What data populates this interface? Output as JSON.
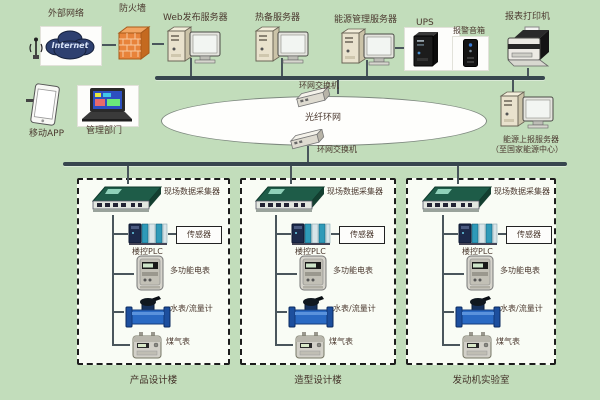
{
  "colors": {
    "background": "#c2ddbb",
    "building_box_fill": "#f9fcf5",
    "bus": "#37464e",
    "connector": "#4a565c",
    "label_text": "#4b392f",
    "firewall_orange": "#e8833a",
    "cloud_blue": "#2e4070",
    "collector_green": "#1e5c48",
    "plc_teal": "#2e9ab8",
    "water_meter_blue": "#2a6ac4",
    "ups_black": "#1c1c1c"
  },
  "top_row": {
    "external_network": {
      "label": "外部网络",
      "cloud_text": "Internet"
    },
    "firewall": {
      "label": "防火墙"
    },
    "web_server": {
      "label": "Web发布服务器"
    },
    "standby_server": {
      "label": "热备服务器"
    },
    "energy_mgmt_server": {
      "label": "能源管理服务器"
    },
    "ups": {
      "label": "UPS"
    },
    "alarm_speaker": {
      "label": "报警音箱"
    },
    "report_printer": {
      "label": "报表打印机"
    }
  },
  "left_panel": {
    "mobile_app": {
      "label": "移动APP"
    },
    "mgmt_dept": {
      "label": "管理部门"
    }
  },
  "ring_network": {
    "ellipse_label": "光纤环网",
    "top_switch_label": "环网交换机",
    "bottom_switch_label": "环网交换机"
  },
  "report_server": {
    "label_line1": "能源上报服务器",
    "label_line2": "（至国家能源中心）"
  },
  "buildings": [
    {
      "name": "产品设计楼",
      "collector": "现场数据采集器",
      "sensor": "传感器",
      "plc": "楼控PLC",
      "electric_meter": "多功能电表",
      "water_meter": "水表/流量计",
      "gas_meter": "煤气表"
    },
    {
      "name": "造型设计楼",
      "collector": "现场数据采集器",
      "sensor": "传感器",
      "plc": "楼控PLC",
      "electric_meter": "多功能电表",
      "water_meter": "水表/流量计",
      "gas_meter": "煤气表"
    },
    {
      "name": "发动机实验室",
      "collector": "现场数据采集器",
      "sensor": "传感器",
      "plc": "楼控PLC",
      "electric_meter": "多功能电表",
      "water_meter": "水表/流量计",
      "gas_meter": "煤气表"
    }
  ]
}
